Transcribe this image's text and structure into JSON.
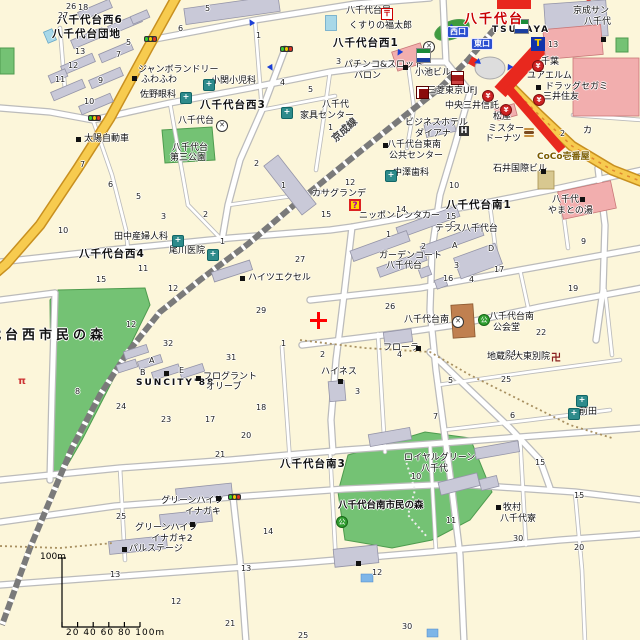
{
  "map": {
    "station": {
      "name": "八千代台",
      "west_exit": "西口",
      "east_exit": "東口"
    },
    "railway_label": "京成線",
    "marker": {
      "symbol": "+",
      "color": "#ff0000"
    },
    "scale_bar": {
      "vertical_label": "100m",
      "tick_labels": "20  40  60  80 100m"
    },
    "colors": {
      "land": "#FCF6DA",
      "park": "#74C274",
      "main_road": "#F7CB4F",
      "station_red": "#E8281E",
      "commercial": "#F2AEae",
      "building": "#C9C9D8"
    },
    "labels": [
      {
        "t": "八千代台西6",
        "x": 57,
        "y": 15,
        "c": "district"
      },
      {
        "t": "八千代台団地",
        "x": 52,
        "y": 29,
        "c": "district"
      },
      {
        "t": "八千代台西3",
        "x": 200,
        "y": 100,
        "c": "district"
      },
      {
        "t": "八千代台西1",
        "x": 333,
        "y": 38,
        "c": "district"
      },
      {
        "t": "八千代台西4",
        "x": 79,
        "y": 249,
        "c": "district"
      },
      {
        "t": "八千代台南1",
        "x": 446,
        "y": 200,
        "c": "district"
      },
      {
        "t": "八千代台南3",
        "x": 280,
        "y": 459,
        "c": "district"
      },
      {
        "t": "八千代台西市民の森",
        "x": -46,
        "y": 329,
        "c": "parkbig"
      },
      {
        "t": "八千代台南市民の森",
        "x": 338,
        "y": 501,
        "c": "parksmall"
      },
      {
        "t": "京成線",
        "x": 330,
        "y": 125,
        "c": "rail"
      },
      {
        "t": "ジャンボランドリー",
        "x": 138,
        "y": 66
      },
      {
        "t": "ふわふわ",
        "x": 141,
        "y": 76
      },
      {
        "t": "佐野眼科",
        "x": 140,
        "y": 91
      },
      {
        "t": "小関小児科",
        "x": 211,
        "y": 77
      },
      {
        "t": "八千代台",
        "x": 178,
        "y": 117
      },
      {
        "t": "八千代台",
        "x": 172,
        "y": 144
      },
      {
        "t": "第三公園",
        "x": 170,
        "y": 154
      },
      {
        "t": "太陽自動車",
        "x": 84,
        "y": 135
      },
      {
        "t": "八千代台局",
        "x": 346,
        "y": 7
      },
      {
        "t": "くすりの福太郎",
        "x": 349,
        "y": 22
      },
      {
        "t": "京成サン",
        "x": 573,
        "y": 7
      },
      {
        "t": "八千代",
        "x": 584,
        "y": 18
      },
      {
        "t": "パチンコ&スロット",
        "x": 344,
        "y": 61
      },
      {
        "t": "バロン",
        "x": 354,
        "y": 72
      },
      {
        "t": "八千代",
        "x": 322,
        "y": 101
      },
      {
        "t": "家具センター",
        "x": 300,
        "y": 112
      },
      {
        "t": "TSUTAYA",
        "x": 492,
        "y": 26,
        "c": "latin"
      },
      {
        "t": "千葉",
        "x": 541,
        "y": 58
      },
      {
        "t": "ユアエルム",
        "x": 527,
        "y": 72
      },
      {
        "t": "ドラッグセガミ",
        "x": 545,
        "y": 83
      },
      {
        "t": "三井住友",
        "x": 543,
        "y": 93
      },
      {
        "t": "三菱東京UFJ",
        "x": 427,
        "y": 87
      },
      {
        "t": "中央三井信託",
        "x": 445,
        "y": 102
      },
      {
        "t": "松屋",
        "x": 493,
        "y": 113
      },
      {
        "t": "ミスター",
        "x": 488,
        "y": 125
      },
      {
        "t": "ドーナツ",
        "x": 485,
        "y": 135
      },
      {
        "t": "ビジネスホテル",
        "x": 405,
        "y": 119
      },
      {
        "t": "ダイアナ",
        "x": 415,
        "y": 130
      },
      {
        "t": "八千代台東南",
        "x": 387,
        "y": 141
      },
      {
        "t": "公共センター",
        "x": 389,
        "y": 152
      },
      {
        "t": "小池ビル",
        "x": 415,
        "y": 69
      },
      {
        "t": "中澤歯科",
        "x": 393,
        "y": 169
      },
      {
        "t": "石井国際ビル",
        "x": 493,
        "y": 165
      },
      {
        "t": "CoCo壱番屋",
        "x": 537,
        "y": 153,
        "c": "coco"
      },
      {
        "t": "八千代",
        "x": 552,
        "y": 196
      },
      {
        "t": "やまとの湯",
        "x": 548,
        "y": 207
      },
      {
        "t": "カサグランデ",
        "x": 312,
        "y": 190
      },
      {
        "t": "ニッポンレンタカー",
        "x": 359,
        "y": 212
      },
      {
        "t": "テラス八千代台",
        "x": 435,
        "y": 225
      },
      {
        "t": "ガーデンコート",
        "x": 379,
        "y": 252
      },
      {
        "t": "八千代台",
        "x": 386,
        "y": 262
      },
      {
        "t": "田中産婦人科",
        "x": 114,
        "y": 233
      },
      {
        "t": "尾川医院",
        "x": 169,
        "y": 247
      },
      {
        "t": "ハイツエクセル",
        "x": 248,
        "y": 274
      },
      {
        "t": "ハイネス",
        "x": 321,
        "y": 368
      },
      {
        "t": "SUNCITY'88",
        "x": 136,
        "y": 379,
        "c": "latin"
      },
      {
        "t": "フログラント",
        "x": 203,
        "y": 373
      },
      {
        "t": "オリーブ",
        "x": 206,
        "y": 383
      },
      {
        "t": "フローラ",
        "x": 383,
        "y": 344
      },
      {
        "t": "地蔵院大東別院",
        "x": 487,
        "y": 353
      },
      {
        "t": "八千代台南",
        "x": 404,
        "y": 316
      },
      {
        "t": "八千代台南",
        "x": 489,
        "y": 313
      },
      {
        "t": "公会堂",
        "x": 493,
        "y": 324
      },
      {
        "t": "ロイヤルグリーン",
        "x": 404,
        "y": 454
      },
      {
        "t": "八千代",
        "x": 421,
        "y": 465
      },
      {
        "t": "牧村",
        "x": 503,
        "y": 504
      },
      {
        "t": "八千代寮",
        "x": 500,
        "y": 515
      },
      {
        "t": "グリーンハイツ",
        "x": 161,
        "y": 497
      },
      {
        "t": "イナガキ",
        "x": 185,
        "y": 508
      },
      {
        "t": "グリーンハイツ",
        "x": 135,
        "y": 524
      },
      {
        "t": "イナガキ2",
        "x": 151,
        "y": 535
      },
      {
        "t": "パルステージ",
        "x": 129,
        "y": 545
      },
      {
        "t": "前田",
        "x": 579,
        "y": 408
      },
      {
        "t": "カ",
        "x": 583,
        "y": 127
      }
    ],
    "numbers": [
      [
        66,
        3,
        "26"
      ],
      [
        78,
        4,
        "18"
      ],
      [
        58,
        12,
        "27"
      ],
      [
        205,
        5,
        "5"
      ],
      [
        126,
        39,
        "5"
      ],
      [
        75,
        48,
        "13"
      ],
      [
        68,
        62,
        "12"
      ],
      [
        116,
        51,
        "7"
      ],
      [
        98,
        77,
        "9"
      ],
      [
        84,
        98,
        "10"
      ],
      [
        55,
        76,
        "11"
      ],
      [
        178,
        25,
        "6"
      ],
      [
        256,
        32,
        "1"
      ],
      [
        280,
        79,
        "4"
      ],
      [
        308,
        86,
        "5"
      ],
      [
        336,
        58,
        "3"
      ],
      [
        548,
        41,
        "13"
      ],
      [
        560,
        130,
        "2"
      ],
      [
        328,
        124,
        "1"
      ],
      [
        254,
        160,
        "2"
      ],
      [
        80,
        161,
        "7"
      ],
      [
        108,
        181,
        "6"
      ],
      [
        136,
        193,
        "5"
      ],
      [
        161,
        213,
        "3"
      ],
      [
        203,
        211,
        "2"
      ],
      [
        281,
        182,
        "1"
      ],
      [
        58,
        227,
        "10"
      ],
      [
        138,
        265,
        "11"
      ],
      [
        168,
        285,
        "12"
      ],
      [
        295,
        256,
        "27"
      ],
      [
        256,
        307,
        "29"
      ],
      [
        220,
        238,
        "1"
      ],
      [
        96,
        276,
        "15"
      ],
      [
        345,
        179,
        "12"
      ],
      [
        321,
        211,
        "15"
      ],
      [
        396,
        206,
        "14"
      ],
      [
        386,
        231,
        "1"
      ],
      [
        449,
        182,
        "10"
      ],
      [
        421,
        243,
        "2"
      ],
      [
        452,
        242,
        "A"
      ],
      [
        488,
        245,
        "D"
      ],
      [
        450,
        221,
        "C"
      ],
      [
        454,
        262,
        "3"
      ],
      [
        469,
        276,
        "4"
      ],
      [
        443,
        275,
        "16"
      ],
      [
        494,
        266,
        "17"
      ],
      [
        581,
        238,
        "9"
      ],
      [
        568,
        285,
        "19"
      ],
      [
        385,
        303,
        "26"
      ],
      [
        446,
        213,
        "15"
      ],
      [
        126,
        321,
        "12"
      ],
      [
        163,
        340,
        "32"
      ],
      [
        226,
        354,
        "31"
      ],
      [
        281,
        340,
        "1"
      ],
      [
        116,
        403,
        "24"
      ],
      [
        161,
        416,
        "23"
      ],
      [
        205,
        416,
        "17"
      ],
      [
        256,
        404,
        "18"
      ],
      [
        241,
        432,
        "20"
      ],
      [
        215,
        451,
        "21"
      ],
      [
        75,
        388,
        "8"
      ],
      [
        320,
        351,
        "2"
      ],
      [
        397,
        351,
        "4"
      ],
      [
        355,
        388,
        "3"
      ],
      [
        448,
        377,
        "5"
      ],
      [
        536,
        329,
        "22"
      ],
      [
        506,
        350,
        "24"
      ],
      [
        501,
        376,
        "25"
      ],
      [
        433,
        413,
        "7"
      ],
      [
        510,
        412,
        "6"
      ],
      [
        535,
        459,
        "15"
      ],
      [
        411,
        473,
        "10"
      ],
      [
        116,
        513,
        "25"
      ],
      [
        263,
        528,
        "14"
      ],
      [
        241,
        565,
        "13"
      ],
      [
        110,
        571,
        "13"
      ],
      [
        171,
        598,
        "12"
      ],
      [
        225,
        620,
        "21"
      ],
      [
        298,
        632,
        "25"
      ],
      [
        446,
        517,
        "11"
      ],
      [
        513,
        535,
        "30"
      ],
      [
        574,
        544,
        "20"
      ],
      [
        574,
        492,
        "15"
      ],
      [
        372,
        569,
        "12"
      ],
      [
        402,
        623,
        "30"
      ],
      [
        149,
        357,
        "A"
      ],
      [
        140,
        369,
        "B"
      ],
      [
        179,
        367,
        "E"
      ]
    ],
    "icons": [
      {
        "t": "hospital",
        "x": 180,
        "y": 92
      },
      {
        "t": "hospital",
        "x": 203,
        "y": 79
      },
      {
        "t": "hospital",
        "x": 172,
        "y": 235
      },
      {
        "t": "hospital",
        "x": 207,
        "y": 249
      },
      {
        "t": "hospital",
        "x": 385,
        "y": 170
      },
      {
        "t": "hospital",
        "x": 576,
        "y": 395
      },
      {
        "t": "hospital",
        "x": 568,
        "y": 408
      },
      {
        "t": "hospital",
        "x": 281,
        "y": 107
      },
      {
        "t": "bank",
        "x": 532,
        "y": 60
      },
      {
        "t": "bank",
        "x": 533,
        "y": 94
      },
      {
        "t": "bank",
        "x": 482,
        "y": 90
      },
      {
        "t": "bank",
        "x": 500,
        "y": 104
      },
      {
        "t": "ufjsq",
        "x": 416,
        "y": 86
      },
      {
        "t": "police",
        "x": 216,
        "y": 120
      },
      {
        "t": "police",
        "x": 452,
        "y": 316
      },
      {
        "t": "police",
        "x": 423,
        "y": 41
      },
      {
        "t": "park",
        "x": 478,
        "y": 314
      },
      {
        "t": "park",
        "x": 336,
        "y": 516
      },
      {
        "t": "post",
        "x": 381,
        "y": 8
      },
      {
        "t": "temple",
        "x": 551,
        "y": 354
      },
      {
        "t": "torii",
        "x": 18,
        "y": 377
      },
      {
        "t": "traffic",
        "x": 144,
        "y": 36
      },
      {
        "t": "traffic",
        "x": 280,
        "y": 46
      },
      {
        "t": "traffic",
        "x": 88,
        "y": 115
      },
      {
        "t": "traffic",
        "x": 228,
        "y": 494
      },
      {
        "t": "arrow",
        "x": 248,
        "y": 18,
        "r": -30
      },
      {
        "t": "arrow",
        "x": 268,
        "y": 64,
        "r": 150
      },
      {
        "t": "arrow",
        "x": 396,
        "y": 49,
        "r": 210
      },
      {
        "t": "arrow",
        "x": 448,
        "y": 24,
        "r": 225
      },
      {
        "t": "arrow",
        "x": 474,
        "y": 58,
        "r": 250
      },
      {
        "t": "arrow",
        "x": 506,
        "y": 64,
        "r": 210
      },
      {
        "t": "poi",
        "x": 132,
        "y": 76
      },
      {
        "t": "poi",
        "x": 76,
        "y": 137
      },
      {
        "t": "poi",
        "x": 403,
        "y": 65
      },
      {
        "t": "poi",
        "x": 580,
        "y": 197
      },
      {
        "t": "poi",
        "x": 536,
        "y": 85
      },
      {
        "t": "poi",
        "x": 541,
        "y": 169
      },
      {
        "t": "poi",
        "x": 240,
        "y": 276
      },
      {
        "t": "poi",
        "x": 338,
        "y": 379
      },
      {
        "t": "poi",
        "x": 416,
        "y": 346
      },
      {
        "t": "poi",
        "x": 164,
        "y": 371
      },
      {
        "t": "poi",
        "x": 196,
        "y": 376
      },
      {
        "t": "poi",
        "x": 216,
        "y": 496
      },
      {
        "t": "poi",
        "x": 190,
        "y": 522
      },
      {
        "t": "poi",
        "x": 122,
        "y": 547
      },
      {
        "t": "poi",
        "x": 496,
        "y": 505
      },
      {
        "t": "poi",
        "x": 356,
        "y": 561
      },
      {
        "t": "poi",
        "x": 601,
        "y": 37
      },
      {
        "t": "poi",
        "x": 383,
        "y": 143
      },
      {
        "t": "qbadge",
        "x": 349,
        "y": 199
      },
      {
        "t": "stripelogo",
        "x": 514,
        "y": 19
      },
      {
        "t": "stripelogo",
        "x": 416,
        "y": 48
      },
      {
        "t": "tsutayalogo",
        "x": 531,
        "y": 37
      },
      {
        "t": "redstripe",
        "x": 451,
        "y": 71
      },
      {
        "t": "hotel",
        "x": 459,
        "y": 126
      },
      {
        "t": "burger",
        "x": 524,
        "y": 128
      }
    ]
  }
}
